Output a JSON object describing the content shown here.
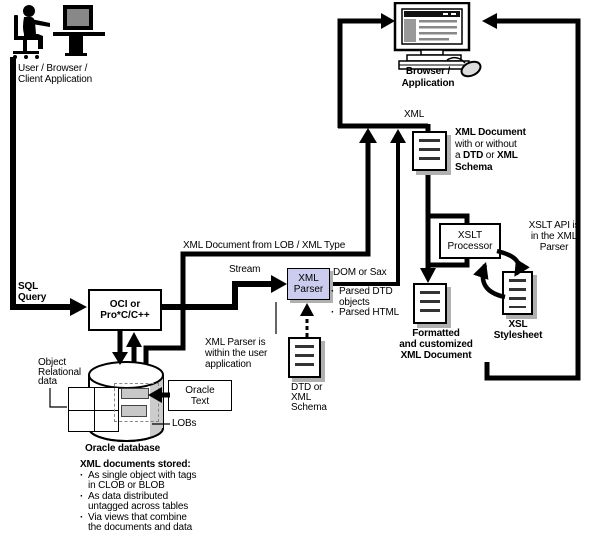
{
  "colors": {
    "line": "#000000",
    "parser_fill": "#ccccee",
    "doc_shadow": "#b0b0b0",
    "lob_fill": "#c8c8c8",
    "screen_gray": "#999999"
  },
  "labels": {
    "user": {
      "lines": [
        "User / Browser /",
        "Client Application"
      ]
    },
    "sql": {
      "lines": [
        "SQL",
        "Query"
      ]
    },
    "oci": {
      "lines": [
        "OCI or",
        "Pro*C/C++"
      ]
    },
    "lob_xml_type": "XML Document from LOB / XML Type",
    "stream": "Stream",
    "xml_parser": {
      "lines": [
        "XML",
        "Parser"
      ]
    },
    "dom_or_sax": "DOM or Sax",
    "parsed_items": [
      [
        "Parsed DTD",
        "objects"
      ],
      [
        "Parsed HTML"
      ]
    ],
    "xml_top": "XML",
    "browser": {
      "lines": [
        "Browser /",
        "Application"
      ]
    },
    "xml_doc_rich": [
      [
        {
          "t": "XML Document",
          "b": true
        }
      ],
      [
        {
          "t": "with or without",
          "b": false
        }
      ],
      [
        {
          "t": "a ",
          "b": false
        },
        {
          "t": "DTD",
          "b": true
        },
        {
          "t": " or ",
          "b": false
        },
        {
          "t": "XML",
          "b": true
        }
      ],
      [
        {
          "t": "Schema",
          "b": true
        }
      ]
    ],
    "xslt": {
      "lines": [
        "XSLT",
        "Processor"
      ]
    },
    "xslt_api": {
      "lines": [
        "XSLT API is",
        "in the XML",
        "Parser"
      ]
    },
    "xsl_sheet": {
      "lines": [
        "XSL",
        "Stylesheet"
      ]
    },
    "formatted": {
      "lines": [
        "Formatted",
        "and customized",
        "XML Document"
      ]
    },
    "parser_note": {
      "lines": [
        "XML Parser is",
        "within the user",
        "application"
      ]
    },
    "dtd": {
      "lines": [
        "DTD or",
        "XML",
        "Schema"
      ]
    },
    "oracle_text": {
      "lines": [
        "Oracle",
        "Text"
      ]
    },
    "obj_rel": {
      "lines": [
        "Object",
        "Relational",
        "data"
      ]
    },
    "lobs": "LOBs",
    "oracle_db": "Oracle database",
    "stored": {
      "heading": "XML documents stored:",
      "items": [
        [
          "As single object with tags",
          "in CLOB or BLOB"
        ],
        [
          "As data distributed",
          "untagged across tables"
        ],
        [
          "Via views that combine",
          "the documents and data"
        ]
      ]
    }
  }
}
